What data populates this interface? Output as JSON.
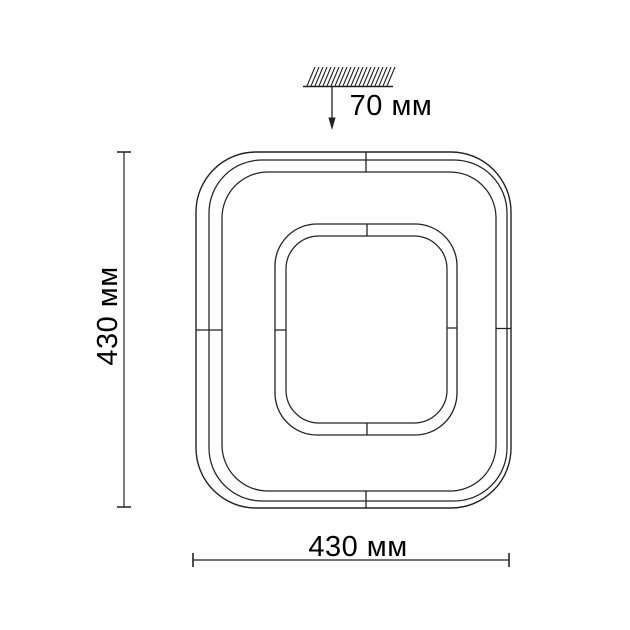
{
  "drawing": {
    "background_color": "#ffffff",
    "line_color": "#222222",
    "text_color": "#000000",
    "labels": {
      "height": "430 мм",
      "width": "430 мм",
      "ceiling_offset": "70 мм"
    },
    "icons": {
      "ceiling_hatch_icon": "diagonal-hatching-over-line",
      "offset_arrow_icon": "↓"
    }
  }
}
